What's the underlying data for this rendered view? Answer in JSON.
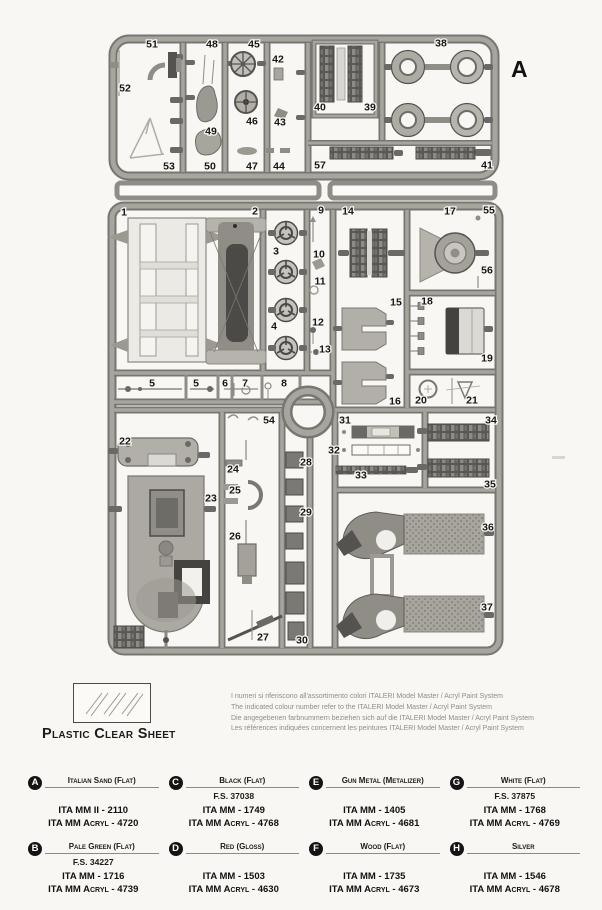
{
  "sprue": {
    "letter": "A",
    "parts": [
      {
        "n": "51",
        "x": 152,
        "y": 44
      },
      {
        "n": "52",
        "x": 125,
        "y": 88
      },
      {
        "n": "53",
        "x": 169,
        "y": 166
      },
      {
        "n": "48",
        "x": 212,
        "y": 44
      },
      {
        "n": "49",
        "x": 211,
        "y": 131
      },
      {
        "n": "50",
        "x": 210,
        "y": 166
      },
      {
        "n": "45",
        "x": 254,
        "y": 44
      },
      {
        "n": "46",
        "x": 252,
        "y": 121
      },
      {
        "n": "47",
        "x": 252,
        "y": 166
      },
      {
        "n": "42",
        "x": 278,
        "y": 59
      },
      {
        "n": "43",
        "x": 280,
        "y": 122
      },
      {
        "n": "44",
        "x": 279,
        "y": 166
      },
      {
        "n": "40",
        "x": 320,
        "y": 107
      },
      {
        "n": "39",
        "x": 370,
        "y": 107
      },
      {
        "n": "38",
        "x": 441,
        "y": 43
      },
      {
        "n": "57",
        "x": 320,
        "y": 165
      },
      {
        "n": "41",
        "x": 487,
        "y": 165
      },
      {
        "n": "1",
        "x": 124,
        "y": 212
      },
      {
        "n": "2",
        "x": 255,
        "y": 211
      },
      {
        "n": "3",
        "x": 276,
        "y": 251
      },
      {
        "n": "4",
        "x": 274,
        "y": 326
      },
      {
        "n": "9",
        "x": 321,
        "y": 210
      },
      {
        "n": "10",
        "x": 319,
        "y": 254
      },
      {
        "n": "11",
        "x": 320,
        "y": 281
      },
      {
        "n": "12",
        "x": 318,
        "y": 322
      },
      {
        "n": "13",
        "x": 325,
        "y": 349
      },
      {
        "n": "14",
        "x": 348,
        "y": 211
      },
      {
        "n": "15",
        "x": 396,
        "y": 302
      },
      {
        "n": "16",
        "x": 395,
        "y": 401
      },
      {
        "n": "17",
        "x": 450,
        "y": 211
      },
      {
        "n": "55",
        "x": 489,
        "y": 210
      },
      {
        "n": "56",
        "x": 487,
        "y": 270
      },
      {
        "n": "18",
        "x": 427,
        "y": 301
      },
      {
        "n": "19",
        "x": 487,
        "y": 358
      },
      {
        "n": "20",
        "x": 421,
        "y": 400
      },
      {
        "n": "21",
        "x": 472,
        "y": 400
      },
      {
        "n": "5",
        "x": 152,
        "y": 383
      },
      {
        "n": "5",
        "x": 196,
        "y": 383
      },
      {
        "n": "6",
        "x": 225,
        "y": 383
      },
      {
        "n": "7",
        "x": 245,
        "y": 383
      },
      {
        "n": "8",
        "x": 284,
        "y": 383
      },
      {
        "n": "54",
        "x": 269,
        "y": 420
      },
      {
        "n": "22",
        "x": 125,
        "y": 441
      },
      {
        "n": "23",
        "x": 211,
        "y": 498
      },
      {
        "n": "24",
        "x": 233,
        "y": 469
      },
      {
        "n": "25",
        "x": 235,
        "y": 490
      },
      {
        "n": "26",
        "x": 235,
        "y": 536
      },
      {
        "n": "27",
        "x": 263,
        "y": 637
      },
      {
        "n": "28",
        "x": 306,
        "y": 462
      },
      {
        "n": "29",
        "x": 306,
        "y": 512
      },
      {
        "n": "30",
        "x": 302,
        "y": 640
      },
      {
        "n": "31",
        "x": 345,
        "y": 420
      },
      {
        "n": "32",
        "x": 334,
        "y": 450
      },
      {
        "n": "33",
        "x": 361,
        "y": 475
      },
      {
        "n": "34",
        "x": 491,
        "y": 420
      },
      {
        "n": "35",
        "x": 490,
        "y": 484
      },
      {
        "n": "36",
        "x": 488,
        "y": 527
      },
      {
        "n": "37",
        "x": 487,
        "y": 607
      }
    ]
  },
  "clear_sheet": {
    "label": "Plastic Clear Sheet"
  },
  "notes": {
    "lines": [
      "I numeri si riferiscono all'assortimento colori ITALERI Model Master / Acryl Paint System",
      "The indicated colour number refer to the ITALERI Model Master / Acryl Paint System",
      "Die angegebenen farbnummern beziehen sich auf die ITALERI Model Master / Acryl Paint System",
      "Les références indiquées concernent les peintures ITALERI Model Master / Acryl Paint System"
    ]
  },
  "legend": {
    "entries": [
      {
        "key": "A",
        "name": "Italian Sand (Flat)",
        "fs": "",
        "codes": [
          "ITA MM II - 2110",
          "ITA MM Acryl - 4720"
        ]
      },
      {
        "key": "B",
        "name": "Pale Green (Flat)",
        "fs": "F.S. 34227",
        "codes": [
          "ITA MM - 1716",
          "ITA MM Acryl - 4739"
        ]
      },
      {
        "key": "C",
        "name": "Black (Flat)",
        "fs": "F.S. 37038",
        "codes": [
          "ITA MM - 1749",
          "ITA MM Acryl - 4768"
        ]
      },
      {
        "key": "D",
        "name": "Red (Gloss)",
        "fs": "",
        "codes": [
          "ITA MM - 1503",
          "ITA MM Acryl - 4630"
        ]
      },
      {
        "key": "E",
        "name": "Gun Metal (Metalizer)",
        "fs": "",
        "codes": [
          "ITA MM - 1405",
          "ITA MM Acryl - 4681"
        ]
      },
      {
        "key": "F",
        "name": "Wood (Flat)",
        "fs": "",
        "codes": [
          "ITA MM - 1735",
          "ITA MM Acryl - 4673"
        ]
      },
      {
        "key": "G",
        "name": "White (Flat)",
        "fs": "F.S. 37875",
        "codes": [
          "ITA MM - 1768",
          "ITA MM Acryl - 4769"
        ]
      },
      {
        "key": "H",
        "name": "Silver",
        "fs": "",
        "codes": [
          "ITA MM - 1546",
          "ITA MM Acryl - 4678"
        ]
      }
    ]
  },
  "colors": {
    "paper": "#f8f7f3",
    "runner_light": "#a8a59e",
    "runner_dark": "#787671",
    "part_light": "#b6b3ac",
    "part_mid": "#8f8d86",
    "part_dark": "#55534f",
    "ink": "#1a1a1a",
    "note_gray": "#8f8d88"
  }
}
